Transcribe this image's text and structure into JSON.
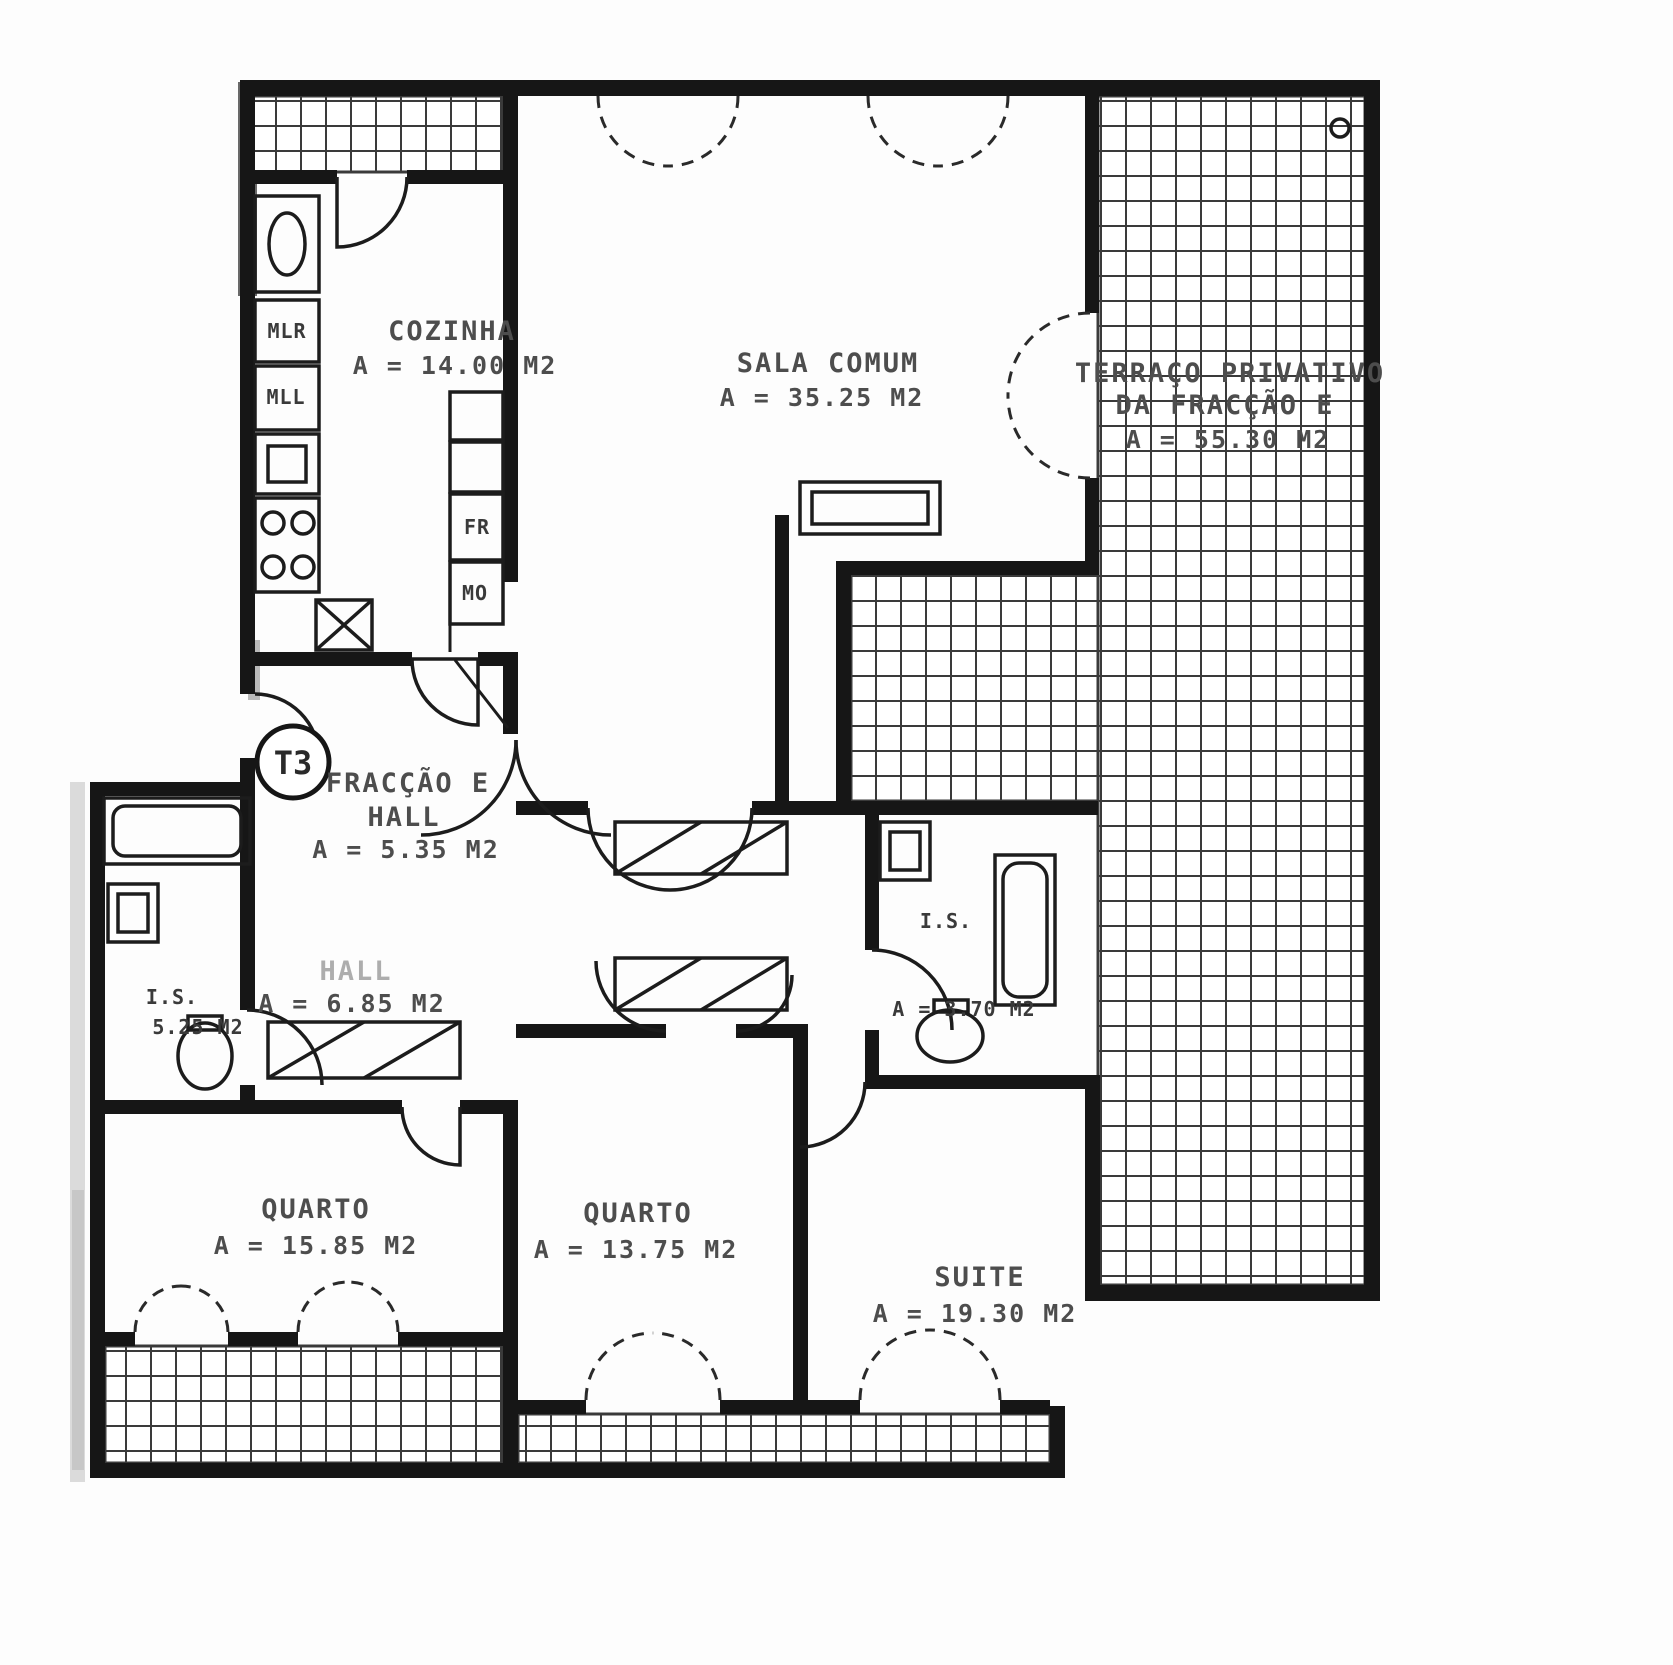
{
  "badge": {
    "label": "T3"
  },
  "rooms": {
    "cozinha": {
      "name": "COZINHA",
      "area": "A = 14.00 M2"
    },
    "sala_comum": {
      "name": "SALA COMUM",
      "area": "A = 35.25 M2"
    },
    "terraco": {
      "name": "TERRAÇO PRIVATIVO",
      "name2": "DA FRACÇÃO E",
      "area": "A = 55.30 M2"
    },
    "fraccao_hall": {
      "name": "FRACÇÃO E",
      "name2": "HALL",
      "area": "A = 5.35 M2"
    },
    "hall": {
      "name": "HALL",
      "area": "A = 6.85 M2"
    },
    "is_esq": {
      "name": "I.S.",
      "area": "5.25 M2"
    },
    "is_dir": {
      "name": "I.S.",
      "area": "A = 3.70 M2"
    },
    "quarto_1": {
      "name": "QUARTO",
      "area": "A = 15.85 M2"
    },
    "quarto_2": {
      "name": "QUARTO",
      "area": "A = 13.75 M2"
    },
    "suite": {
      "name": "SUITE",
      "area": "A = 19.30 M2"
    }
  },
  "appliances": {
    "mlr": "MLR",
    "mll": "MLL",
    "fr": "FR",
    "mo": "MO"
  },
  "colors": {
    "wall": "#161616",
    "tile": "#3a3a3a",
    "label": "#4d4d4d",
    "paper": "#ffffff"
  }
}
